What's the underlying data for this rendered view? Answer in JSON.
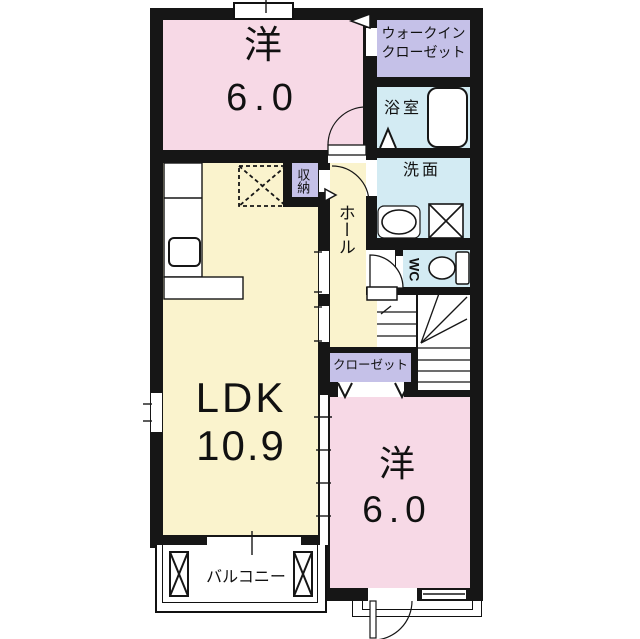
{
  "floorplan": {
    "rooms": {
      "bedroom_top": {
        "name": "洋",
        "size": "6.0"
      },
      "walkin_closet": {
        "line1": "ウォークイン",
        "line2": "クローゼット"
      },
      "bathroom": {
        "name": "浴室"
      },
      "washroom": {
        "name": "洗面"
      },
      "toilet": {
        "name": "WC"
      },
      "hall": {
        "name": "ホール"
      },
      "storage": {
        "name": "収納"
      },
      "closet": {
        "name": "クローゼット"
      },
      "ldk": {
        "name": "LDK",
        "size": "10.9"
      },
      "bedroom_bottom": {
        "name": "洋",
        "size": "6.0"
      },
      "balcony": {
        "name": "バルコニー"
      }
    },
    "colors": {
      "wall": "#161616",
      "room_pink": "#f7d9e6",
      "room_yellow": "#faf3cd",
      "room_lavender": "#c5c1e8",
      "room_cyan": "#d3ebf3"
    }
  }
}
